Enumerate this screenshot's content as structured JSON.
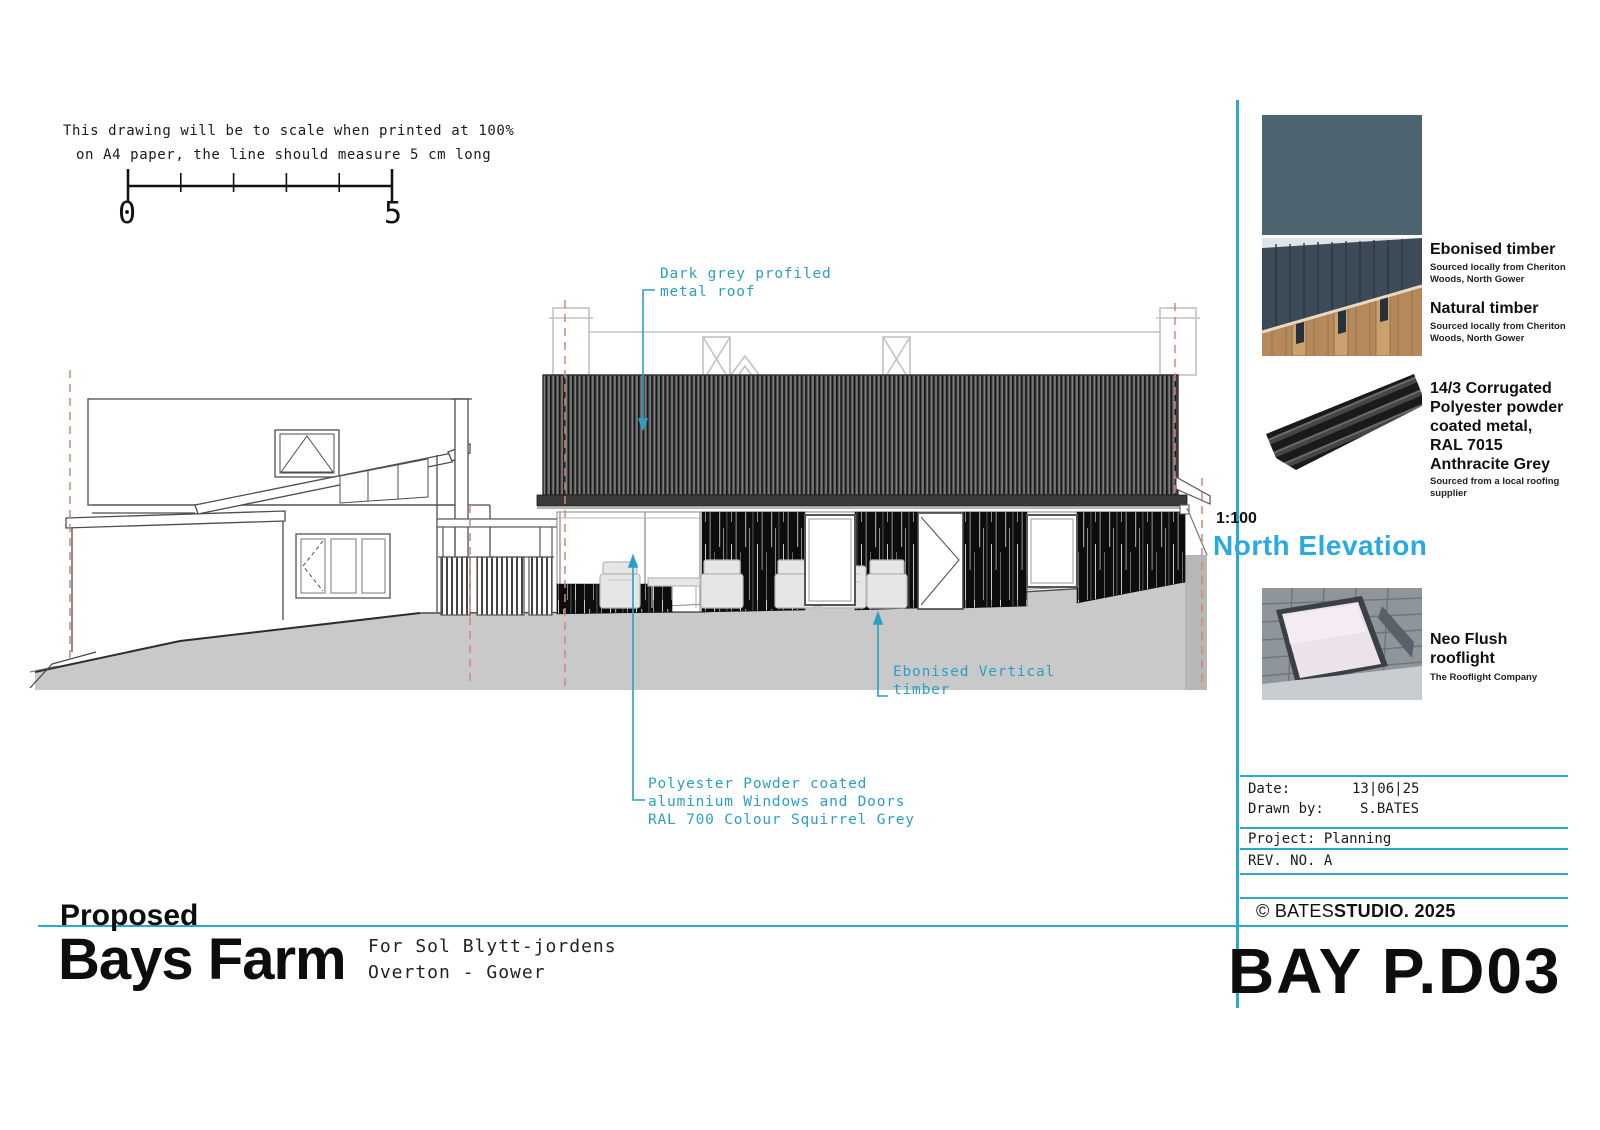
{
  "colors": {
    "annotation_cyan": "#2b9fc6",
    "title_cyan": "#29abe2",
    "divider_cyan": "#2ba8cf",
    "swatch_slate": "#4e6470",
    "ground_grey": "#c9c9c9",
    "datum_red_dashed": "#d4867c",
    "roof_dark_grey": "#3a3a3a"
  },
  "scale_note": {
    "line1": "This drawing will be to scale when printed at 100%",
    "line2": "on A4 paper, the line should measure 5 cm long",
    "start": "0",
    "end": "5"
  },
  "annotations": {
    "roof": {
      "line1": "Dark grey profiled",
      "line2": "metal roof"
    },
    "timber": {
      "line1": "Ebonised Vertical",
      "line2": "timber"
    },
    "windows": {
      "line1": "Polyester Powder coated",
      "line2": "aluminium Windows and Doors",
      "line3": "RAL 700 Colour Squirrel Grey"
    }
  },
  "sidebar": {
    "materials": [
      {
        "name": "Ebonised timber",
        "source": "Sourced locally from Cheriton\nWoods, North Gower"
      },
      {
        "name": "Natural timber",
        "source": "Sourced locally from Cheriton\nWoods, North Gower"
      },
      {
        "name": "14/3 Corrugated\nPolyester powder\ncoated metal,\nRAL 7015\nAnthracite Grey",
        "source": "Sourced from a local roofing\nsupplier"
      },
      {
        "name": "Neo Flush\nrooflight",
        "source": "The Rooflight Company"
      }
    ],
    "scale": "1:100",
    "view_title": "North Elevation",
    "titleblock": {
      "date_label": "Date:",
      "date_value": "13|06|25",
      "drawn_label": "Drawn by:",
      "drawn_value": "S.BATES",
      "project": "Project: Planning",
      "rev": "REV. NO. A",
      "copyright_prefix": "© BATES",
      "copyright_bold": "STUDIO. 2025"
    },
    "sheet_number": "BAY P.D03"
  },
  "footer": {
    "proposed": "Proposed",
    "project_name": "Bays Farm",
    "client_line1": "For Sol Blytt-jordens",
    "client_line2": "Overton  -  Gower"
  }
}
